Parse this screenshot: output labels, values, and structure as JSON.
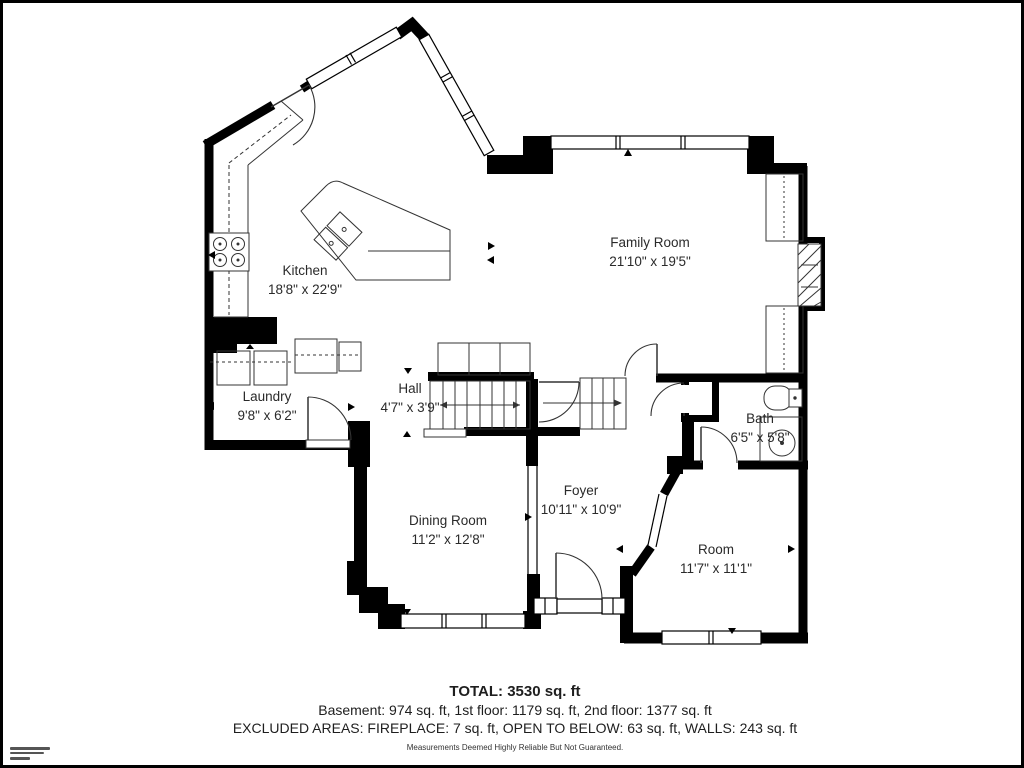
{
  "rooms": [
    {
      "id": "kitchen",
      "name": "Kitchen",
      "dims": "18'8\" x 22'9\""
    },
    {
      "id": "family-room",
      "name": "Family Room",
      "dims": "21'10\" x 19'5\""
    },
    {
      "id": "laundry",
      "name": "Laundry",
      "dims": "9'8\" x 6'2\""
    },
    {
      "id": "hall",
      "name": "Hall",
      "dims": "4'7\" x 3'9\""
    },
    {
      "id": "bath",
      "name": "Bath",
      "dims": "6'5\" x 5'8\""
    },
    {
      "id": "dining-room",
      "name": "Dining Room",
      "dims": "11'2\" x 12'8\""
    },
    {
      "id": "foyer",
      "name": "Foyer",
      "dims": "10'11\" x 10'9\""
    },
    {
      "id": "room",
      "name": "Room",
      "dims": "11'7\" x 11'1\""
    }
  ],
  "summary": {
    "total": "TOTAL: 3530 sq. ft",
    "floors": "Basement: 974 sq. ft, 1st floor: 1179 sq. ft, 2nd floor: 1377 sq. ft",
    "excluded": "EXCLUDED AREAS: FIREPLACE: 7 sq. ft, OPEN TO BELOW: 63 sq. ft, WALLS: 243 sq. ft",
    "disclaimer": "Measurements Deemed Highly Reliable But Not Guaranteed."
  },
  "colors": {
    "wall": "#000000",
    "background": "#ffffff",
    "text": "#222222"
  }
}
